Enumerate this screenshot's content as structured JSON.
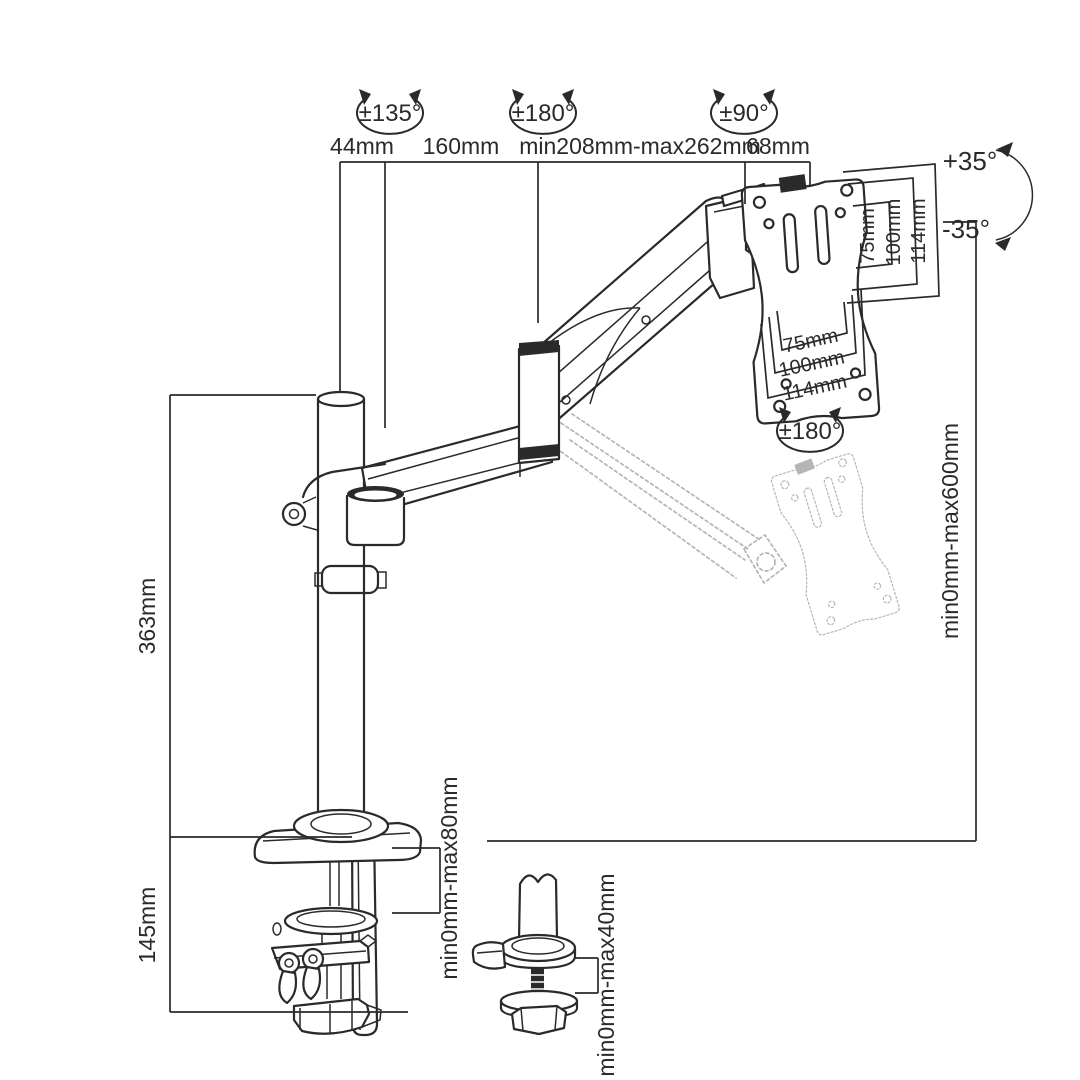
{
  "diagram": {
    "kind": "technical dimension drawing",
    "subject": "gas-spring single monitor desk mount arm",
    "background": "#ffffff",
    "line_color": "#2a2a2a",
    "ghost_line_color": "#b5b5b5"
  },
  "rotations": {
    "pole": "±135°",
    "elbow": "±180°",
    "head": "±90°",
    "vesa": "±180°",
    "tilt_up": "+35°",
    "tilt_down": "-35°"
  },
  "dims": {
    "pole_offset": "44mm",
    "arm_front": "160mm",
    "arm_gas": "min208mm-max262mm",
    "head": "68mm",
    "pole_height": "363mm",
    "clamp_height": "145mm",
    "height_range": "min0mm-max600mm",
    "clamp_range": "min0mm-max80mm",
    "grommet_range": "min0mm-max40mm",
    "vesa_right": [
      "75mm",
      "100mm",
      "114mm"
    ],
    "vesa_bottom": [
      "75mm",
      "100mm",
      "114mm"
    ]
  }
}
